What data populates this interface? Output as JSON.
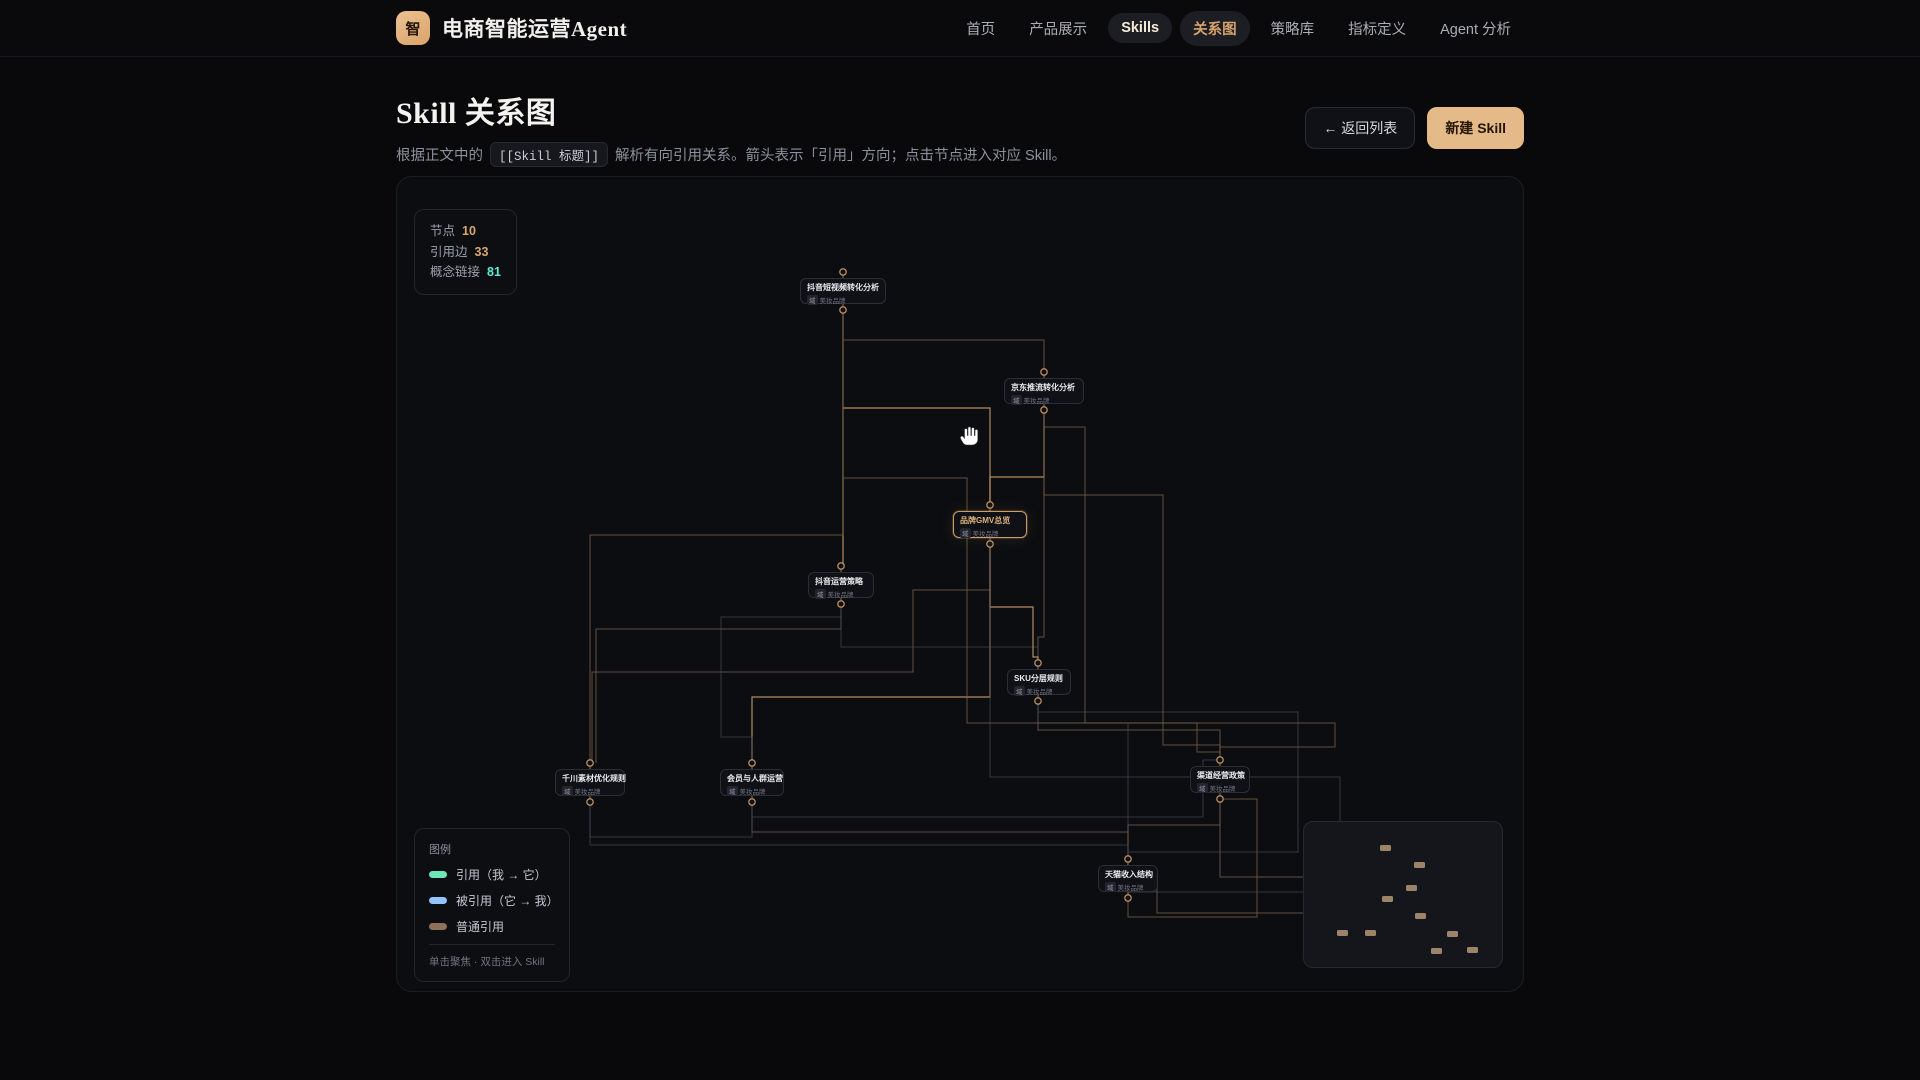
{
  "brand": {
    "logo_char": "智",
    "title": "电商智能运营Agent"
  },
  "nav": {
    "items": [
      {
        "label": "首页",
        "style": "plain"
      },
      {
        "label": "产品展示",
        "style": "plain"
      },
      {
        "label": "Skills",
        "style": "pill-skills"
      },
      {
        "label": "关系图",
        "style": "pill-active"
      },
      {
        "label": "策略库",
        "style": "plain"
      },
      {
        "label": "指标定义",
        "style": "plain"
      },
      {
        "label": "Agent 分析",
        "style": "plain"
      }
    ]
  },
  "page": {
    "title": "Skill 关系图",
    "subtitle_prefix": "根据正文中的",
    "subtitle_code": "[[Skill 标题]]",
    "subtitle_suffix": "解析有向引用关系。箭头表示「引用」方向；点击节点进入对应 Skill。",
    "back_button": "← 返回列表",
    "new_button": "新建 Skill"
  },
  "stats": [
    {
      "label": "节点",
      "value": "10",
      "color": "#d9a86c"
    },
    {
      "label": "引用边",
      "value": "33",
      "color": "#d9a86c"
    },
    {
      "label": "概念链接",
      "value": "81",
      "color": "#5eead4"
    }
  ],
  "legend": {
    "title": "图例",
    "items": [
      {
        "label": "引用（我 → 它）",
        "color": "#6ee7b7"
      },
      {
        "label": "被引用（它 → 我）",
        "color": "#93c5fd"
      },
      {
        "label": "普通引用",
        "color": "#8d7158"
      }
    ],
    "footer": "单击聚焦 · 双击进入 Skill"
  },
  "graph": {
    "sub_tag": "域",
    "sub_text": "美妆品牌",
    "colors": {
      "tan": "#75604a",
      "bright": "#bd9365",
      "gray": "#49505e",
      "port": "#b98e5f"
    },
    "nodes": [
      {
        "id": "n1",
        "title": "抖音短视频转化分析",
        "x": 403,
        "y": 101,
        "w": 86,
        "h": 26,
        "cx": 446,
        "pt": 95,
        "pb": 133,
        "focused": false
      },
      {
        "id": "n2",
        "title": "京东推流转化分析",
        "x": 607,
        "y": 201,
        "w": 80,
        "h": 26,
        "cx": 647,
        "pt": 195,
        "pb": 233,
        "focused": false
      },
      {
        "id": "n3",
        "title": "品牌GMV总览",
        "x": 556,
        "y": 334,
        "w": 74,
        "h": 27,
        "cx": 593,
        "pt": 328,
        "pb": 367,
        "focused": true
      },
      {
        "id": "n4",
        "title": "抖音运营策略",
        "x": 411,
        "y": 395,
        "w": 66,
        "h": 26,
        "cx": 444,
        "pt": 389,
        "pb": 427,
        "focused": false
      },
      {
        "id": "n5",
        "title": "SKU分层规则",
        "x": 610,
        "y": 492,
        "w": 64,
        "h": 26,
        "cx": 641,
        "pt": 486,
        "pb": 524,
        "focused": false
      },
      {
        "id": "n6",
        "title": "千川素材优化规则",
        "x": 158,
        "y": 592,
        "w": 70,
        "h": 27,
        "cx": 193,
        "pt": 586,
        "pb": 625,
        "focused": false
      },
      {
        "id": "n7",
        "title": "会员与人群运营",
        "x": 323,
        "y": 592,
        "w": 64,
        "h": 27,
        "cx": 355,
        "pt": 586,
        "pb": 625,
        "focused": false
      },
      {
        "id": "n8",
        "title": "渠道经营政策",
        "x": 793,
        "y": 589,
        "w": 60,
        "h": 27,
        "cx": 823,
        "pt": 583,
        "pb": 622,
        "focused": false
      },
      {
        "id": "n9",
        "title": "天猫收入结构",
        "x": 701,
        "y": 688,
        "w": 60,
        "h": 27,
        "cx": 731,
        "pt": 682,
        "pb": 721,
        "focused": false
      }
    ],
    "edges": [
      {
        "c": "bright",
        "pts": [
          [
            446,
            133
          ],
          [
            446,
            389
          ]
        ]
      },
      {
        "c": "tan",
        "pts": [
          [
            446,
            133
          ],
          [
            446,
            163
          ],
          [
            647,
            163
          ],
          [
            647,
            195
          ]
        ]
      },
      {
        "c": "tan",
        "pts": [
          [
            647,
            233
          ],
          [
            647,
            460
          ],
          [
            641,
            460
          ],
          [
            641,
            486
          ]
        ]
      },
      {
        "c": "bright",
        "pts": [
          [
            593,
            328
          ],
          [
            593,
            231
          ],
          [
            446,
            231
          ]
        ]
      },
      {
        "c": "bright",
        "pts": [
          [
            647,
            233
          ],
          [
            647,
            300
          ],
          [
            593,
            300
          ],
          [
            593,
            328
          ]
        ]
      },
      {
        "c": "bright",
        "pts": [
          [
            593,
            367
          ],
          [
            593,
            520
          ],
          [
            355,
            520
          ],
          [
            355,
            586
          ]
        ]
      },
      {
        "c": "tan",
        "pts": [
          [
            593,
            367
          ],
          [
            593,
            413
          ],
          [
            516,
            413
          ],
          [
            516,
            495
          ],
          [
            195,
            495
          ],
          [
            195,
            586
          ]
        ]
      },
      {
        "c": "tan",
        "pts": [
          [
            641,
            524
          ],
          [
            641,
            553
          ],
          [
            823,
            553
          ],
          [
            823,
            583
          ]
        ]
      },
      {
        "c": "gray",
        "pts": [
          [
            641,
            524
          ],
          [
            641,
            546
          ],
          [
            731,
            546
          ],
          [
            731,
            682
          ]
        ]
      },
      {
        "c": "tan",
        "pts": [
          [
            444,
            427
          ],
          [
            444,
            452
          ],
          [
            199,
            452
          ],
          [
            199,
            586
          ]
        ]
      },
      {
        "c": "gray",
        "pts": [
          [
            444,
            427
          ],
          [
            444,
            440
          ],
          [
            324,
            440
          ],
          [
            324,
            560
          ],
          [
            355,
            560
          ],
          [
            355,
            586
          ]
        ]
      },
      {
        "c": "gray",
        "pts": [
          [
            444,
            427
          ],
          [
            444,
            470
          ],
          [
            641,
            470
          ],
          [
            641,
            486
          ]
        ]
      },
      {
        "c": "bright",
        "pts": [
          [
            593,
            367
          ],
          [
            593,
            430
          ],
          [
            636,
            430
          ],
          [
            636,
            480
          ],
          [
            641,
            480
          ],
          [
            641,
            486
          ]
        ]
      },
      {
        "c": "tan",
        "pts": [
          [
            446,
            133
          ],
          [
            446,
            301
          ],
          [
            570,
            301
          ],
          [
            570,
            546
          ],
          [
            800,
            546
          ],
          [
            800,
            575
          ],
          [
            823,
            575
          ],
          [
            823,
            583
          ]
        ]
      },
      {
        "c": "tan",
        "pts": [
          [
            355,
            625
          ],
          [
            355,
            655
          ],
          [
            731,
            655
          ],
          [
            731,
            682
          ]
        ]
      },
      {
        "c": "gray",
        "pts": [
          [
            193,
            625
          ],
          [
            193,
            660
          ],
          [
            355,
            660
          ],
          [
            355,
            625
          ]
        ]
      },
      {
        "c": "tan",
        "pts": [
          [
            823,
            622
          ],
          [
            823,
            648
          ],
          [
            731,
            648
          ],
          [
            731,
            682
          ]
        ]
      },
      {
        "c": "gray",
        "pts": [
          [
            355,
            625
          ],
          [
            355,
            640
          ],
          [
            806,
            640
          ],
          [
            806,
            583
          ],
          [
            823,
            583
          ]
        ]
      },
      {
        "c": "gray",
        "pts": [
          [
            193,
            625
          ],
          [
            193,
            668
          ],
          [
            731,
            668
          ],
          [
            731,
            682
          ]
        ]
      },
      {
        "c": "tan",
        "pts": [
          [
            647,
            233
          ],
          [
            647,
            250
          ],
          [
            688,
            250
          ],
          [
            688,
            546
          ],
          [
            938,
            546
          ],
          [
            938,
            570
          ],
          [
            823,
            570
          ],
          [
            823,
            583
          ]
        ]
      },
      {
        "c": "tan",
        "pts": [
          [
            823,
            622
          ],
          [
            823,
            700
          ],
          [
            916,
            700
          ],
          [
            916,
            736
          ],
          [
            760,
            736
          ],
          [
            760,
            700
          ],
          [
            731,
            700
          ],
          [
            731,
            721
          ]
        ]
      },
      {
        "c": "tan",
        "pts": [
          [
            731,
            721
          ],
          [
            731,
            740
          ],
          [
            860,
            740
          ],
          [
            860,
            622
          ],
          [
            823,
            622
          ]
        ]
      },
      {
        "c": "gray",
        "pts": [
          [
            641,
            524
          ],
          [
            641,
            535
          ],
          [
            901,
            535
          ],
          [
            901,
            675
          ],
          [
            731,
            675
          ],
          [
            731,
            682
          ]
        ]
      },
      {
        "c": "tan",
        "pts": [
          [
            446,
            133
          ],
          [
            446,
            358
          ],
          [
            193,
            358
          ],
          [
            193,
            586
          ]
        ]
      },
      {
        "c": "gray",
        "pts": [
          [
            593,
            367
          ],
          [
            593,
            600
          ],
          [
            943,
            600
          ],
          [
            943,
            715
          ],
          [
            731,
            715
          ],
          [
            731,
            721
          ]
        ]
      },
      {
        "c": "tan",
        "pts": [
          [
            647,
            233
          ],
          [
            647,
            318
          ],
          [
            766,
            318
          ],
          [
            766,
            568
          ],
          [
            823,
            568
          ],
          [
            823,
            583
          ]
        ]
      }
    ]
  },
  "minimap": {
    "nodes": [
      [
        76,
        23
      ],
      [
        110,
        40
      ],
      [
        102,
        63
      ],
      [
        78,
        74
      ],
      [
        111,
        91
      ],
      [
        33,
        108
      ],
      [
        61,
        108
      ],
      [
        143,
        109
      ],
      [
        127,
        126
      ],
      [
        163,
        125
      ]
    ]
  }
}
